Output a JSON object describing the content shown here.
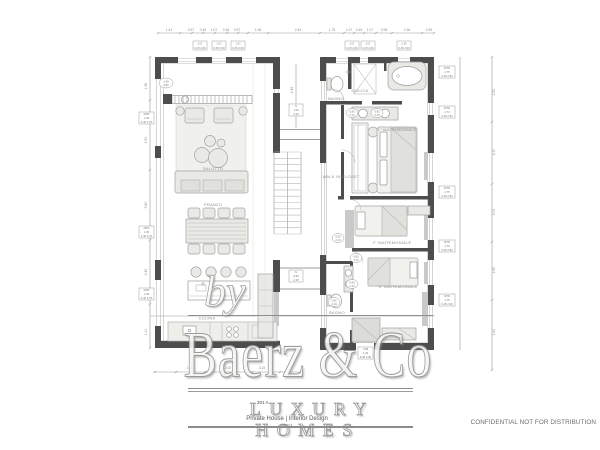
{
  "watermark": {
    "by": "by",
    "brand": "Baerz & Co",
    "tagline": "LUXURY HOMES",
    "sheet_code": "201 A",
    "project": "Private House | Interior Design",
    "year": "2024"
  },
  "footer": {
    "confidential": "CONFIDENTIAL NOT FOR DISTRIBUTION"
  },
  "colors": {
    "wall": "#4d4d4d",
    "furniture_fill": "#e9e9e6",
    "line_gray": "#9a9a9a",
    "label_gray": "#8f8f8f",
    "watermark_gray": "#8c8c8a"
  },
  "plan": {
    "labels": {
      "living": "SALOTTO",
      "dining": "PRANZO",
      "kitchen": "CUCINA",
      "bath_main": "BAGNO",
      "shower": "DOCCIA",
      "master": "1° MATRIMONIALE",
      "walk_in": "WALK IN CLOSET",
      "bedroom2": "2° MATRIMONIALE",
      "bedroom3": "3° MATRIMONIALE",
      "bath2": "BAGNO"
    },
    "dims": {
      "top": [
        "1.41",
        "0.57",
        "0.45",
        "1.07",
        "0.46",
        "0.57",
        "1.98",
        "2.43",
        "1.75",
        "1.07",
        "0.45",
        "1.07",
        "0.98",
        "2.36",
        "0.45"
      ],
      "left": [
        "1.35",
        "2.90",
        "5.80",
        "2.45",
        "1.10"
      ],
      "right": [
        "2.50",
        "4.10",
        "3.00",
        "2.90",
        "1.60"
      ],
      "bottom": [
        "1.45",
        "2.02",
        "3.15"
      ],
      "center": [
        "4.45"
      ]
    },
    "tags": {
      "window_top": [
        {
          "a": "1.07",
          "b": "0.45 2.90"
        },
        {
          "a": "1.07",
          "b": "0.45 2.90"
        },
        {
          "a": "1.07",
          "b": "0.45 2.90"
        },
        {
          "a": "1.07",
          "b": "0.45 2.90"
        },
        {
          "a": "1.07",
          "b": "0.45 2.90"
        },
        {
          "a": "2.36",
          "b": "0.45 2.90"
        }
      ],
      "right": [
        {
          "a": "MTR",
          "b": "1.75",
          "c": "0.45 2.90"
        },
        {
          "a": "MTR",
          "b": "1.74",
          "c": "0.45 2.90"
        },
        {
          "a": "MTR",
          "b": "1.75",
          "c": "0.45 2.90"
        },
        {
          "a": "MTR",
          "b": "1.75",
          "c": "0.45 2.90"
        },
        {
          "a": "MTR",
          "b": "1.75",
          "c": "0.45 2.90"
        }
      ],
      "left": [
        {
          "a": "MTR",
          "b": "1.06",
          "c": "2.40 2.70"
        },
        {
          "a": "MTR",
          "b": "1.06",
          "c": "2.40 2.70"
        },
        {
          "a": "MTR",
          "b": "1.06",
          "c": "2.40 2.70"
        }
      ],
      "bottom": {
        "a": "0.98",
        "b": "1.40",
        "c": "0.45 2.90"
      },
      "center": [
        {
          "a": "N",
          "b": "1.06",
          "c": "2.40"
        },
        {
          "a": "N",
          "b": "0.90",
          "c": "2.40"
        }
      ],
      "door": {
        "a": "0.80",
        "b": "2.10"
      },
      "lamp": {
        "a": "1.45",
        "b": "0.80"
      }
    }
  }
}
